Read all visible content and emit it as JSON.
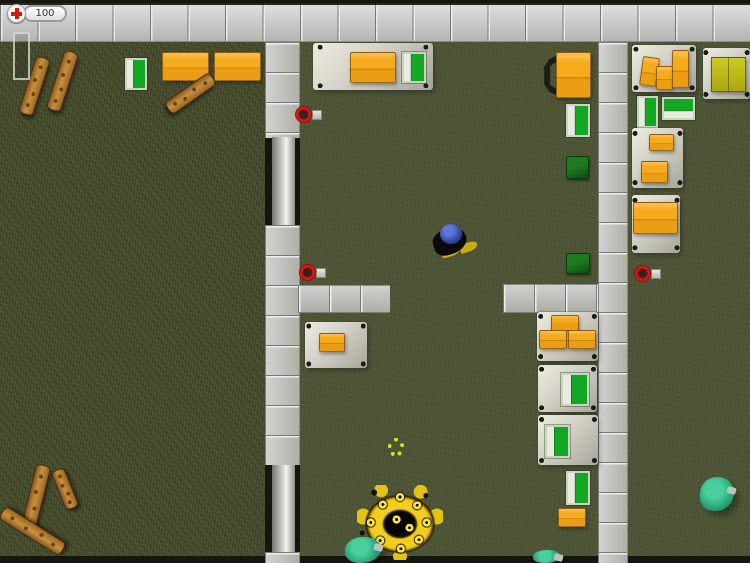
{
  "hud": {
    "health": "100",
    "health_icon": "red-cross-icon",
    "ammo_bar_fill": 0
  },
  "colors": {
    "grass": "#4a5030",
    "room_floor": "#4e5536",
    "wall_tile": "#c4c4c4",
    "crate_orange": "#f6ab1d",
    "crate_yellow": "#cdca22",
    "bed_green": "#12a824",
    "crate_dark_green": "#1d7c1f",
    "zombie_teal": "#26a076",
    "explosion_yellow": "#f1ce1d",
    "pickup_red": "#d11c1c",
    "wood": "#b0772f"
  },
  "scene": {
    "objects": [
      {
        "type": "floor-field",
        "name": "grass-field",
        "x": 0,
        "y": 42,
        "w": 265,
        "h": 521,
        "interactable": false
      },
      {
        "type": "floor-room",
        "name": "room-floor-middle",
        "x": 300,
        "y": 42,
        "w": 298,
        "h": 521,
        "interactable": false
      },
      {
        "type": "floor-room",
        "name": "room-floor-right",
        "x": 628,
        "y": 42,
        "w": 122,
        "h": 521,
        "interactable": false
      },
      {
        "type": "strip-dark",
        "name": "bottom-map-edge",
        "x": 0,
        "y": 556,
        "w": 750,
        "h": 7,
        "interactable": false
      },
      {
        "type": "wall-top",
        "name": "wall-top",
        "x": 0,
        "y": 3,
        "w": 750,
        "h": 39,
        "interactable": false
      },
      {
        "type": "wall-v",
        "name": "wall-left-upper",
        "x": 265,
        "y": 42,
        "w": 35,
        "h": 96,
        "interactable": false
      },
      {
        "type": "door-v",
        "name": "glass-door-upper",
        "x": 272,
        "y": 137,
        "w": 23,
        "h": 88,
        "interactable": true
      },
      {
        "type": "wall-v",
        "name": "wall-left-middle",
        "x": 265,
        "y": 225,
        "w": 35,
        "h": 240,
        "interactable": false
      },
      {
        "type": "door-v",
        "name": "glass-door-lower",
        "x": 272,
        "y": 465,
        "w": 23,
        "h": 87,
        "interactable": true
      },
      {
        "type": "wall-v",
        "name": "wall-left-bottom",
        "x": 265,
        "y": 552,
        "w": 35,
        "h": 11,
        "interactable": false
      },
      {
        "type": "wall-h",
        "name": "wall-branch-west",
        "x": 298,
        "y": 285,
        "w": 92,
        "h": 28,
        "interactable": false
      },
      {
        "type": "wall-h",
        "name": "wall-branch-east",
        "x": 503,
        "y": 284,
        "w": 95,
        "h": 29,
        "interactable": false
      },
      {
        "type": "wall-v",
        "name": "wall-right",
        "x": 598,
        "y": 42,
        "w": 30,
        "h": 521,
        "interactable": false
      },
      {
        "type": "plank",
        "name": "wooden-plank",
        "x": 27,
        "y": 56,
        "w": 15,
        "h": 60,
        "rot": 18,
        "interactable": false
      },
      {
        "type": "plank",
        "name": "wooden-plank",
        "x": 55,
        "y": 50,
        "w": 15,
        "h": 62,
        "rot": 18,
        "interactable": false
      },
      {
        "type": "bed-v",
        "name": "green-bed",
        "x": 125,
        "y": 58,
        "w": 22,
        "h": 32,
        "interactable": false
      },
      {
        "type": "crate-orange",
        "name": "orange-crate",
        "x": 162,
        "y": 52,
        "w": 47,
        "h": 29,
        "interactable": false
      },
      {
        "type": "crate-orange",
        "name": "orange-crate",
        "x": 214,
        "y": 52,
        "w": 47,
        "h": 29,
        "interactable": false
      },
      {
        "type": "plank",
        "name": "wooden-plank",
        "x": 183,
        "y": 66,
        "w": 15,
        "h": 55,
        "rot": 55,
        "interactable": false
      },
      {
        "type": "plank",
        "name": "wooden-plank",
        "x": 28,
        "y": 464,
        "w": 15,
        "h": 70,
        "rot": 14,
        "interactable": false
      },
      {
        "type": "plank",
        "name": "wooden-plank",
        "x": 25,
        "y": 495,
        "w": 15,
        "h": 72,
        "rot": -58,
        "interactable": false
      },
      {
        "type": "plank",
        "name": "wooden-plank",
        "x": 58,
        "y": 468,
        "w": 14,
        "h": 42,
        "rot": -22,
        "interactable": false
      },
      {
        "type": "platform",
        "name": "metal-table",
        "x": 313,
        "y": 43,
        "w": 120,
        "h": 47,
        "interactable": false
      },
      {
        "type": "crate-orange",
        "name": "orange-crate",
        "x": 350,
        "y": 52,
        "w": 46,
        "h": 31,
        "interactable": false
      },
      {
        "type": "bed-v",
        "name": "green-bed",
        "x": 402,
        "y": 52,
        "w": 24,
        "h": 31,
        "interactable": false
      },
      {
        "type": "item-red",
        "name": "weapon-pickup",
        "x": 295,
        "y": 106,
        "w": 27,
        "h": 17,
        "interactable": true
      },
      {
        "type": "locker",
        "name": "shelf-frame",
        "x": 542,
        "y": 54,
        "w": 18,
        "h": 43,
        "interactable": false
      },
      {
        "type": "crate-orange",
        "name": "orange-crate",
        "x": 556,
        "y": 52,
        "w": 35,
        "h": 46,
        "interactable": false
      },
      {
        "type": "bed-v",
        "name": "green-bed",
        "x": 566,
        "y": 104,
        "w": 24,
        "h": 33,
        "interactable": false
      },
      {
        "type": "crate-darkgreen",
        "name": "dark-green-crate",
        "x": 566,
        "y": 156,
        "w": 23,
        "h": 23,
        "interactable": false
      },
      {
        "type": "crate-darkgreen",
        "name": "dark-green-crate",
        "x": 566,
        "y": 253,
        "w": 24,
        "h": 21,
        "interactable": false
      },
      {
        "type": "item-red",
        "name": "weapon-pickup",
        "x": 299,
        "y": 264,
        "w": 27,
        "h": 17,
        "interactable": true
      },
      {
        "type": "player",
        "name": "player-character",
        "x": 430,
        "y": 220,
        "w": 42,
        "h": 42,
        "interactable": true
      },
      {
        "type": "platform",
        "name": "metal-table",
        "x": 305,
        "y": 322,
        "w": 62,
        "h": 46,
        "interactable": false
      },
      {
        "type": "crate-orange-s",
        "name": "orange-crate",
        "x": 319,
        "y": 333,
        "w": 26,
        "h": 19,
        "interactable": false
      },
      {
        "type": "platform",
        "name": "metal-table",
        "x": 537,
        "y": 312,
        "w": 61,
        "h": 49,
        "interactable": false
      },
      {
        "type": "crate-orange-s",
        "name": "orange-crate",
        "x": 551,
        "y": 315,
        "w": 28,
        "h": 16,
        "interactable": false
      },
      {
        "type": "crate-orange-s",
        "name": "orange-crate",
        "x": 539,
        "y": 330,
        "w": 28,
        "h": 19,
        "interactable": false
      },
      {
        "type": "crate-orange-s",
        "name": "orange-crate",
        "x": 568,
        "y": 330,
        "w": 28,
        "h": 19,
        "interactable": false
      },
      {
        "type": "platform",
        "name": "bed-frame",
        "x": 538,
        "y": 365,
        "w": 59,
        "h": 47,
        "interactable": false
      },
      {
        "type": "bed-v",
        "name": "green-bed",
        "x": 561,
        "y": 373,
        "w": 28,
        "h": 33,
        "interactable": false
      },
      {
        "type": "platform",
        "name": "bed-frame",
        "x": 538,
        "y": 415,
        "w": 60,
        "h": 50,
        "interactable": false
      },
      {
        "type": "bed-v",
        "name": "green-bed",
        "x": 545,
        "y": 425,
        "w": 25,
        "h": 33,
        "interactable": false
      },
      {
        "type": "bed-v",
        "name": "green-bed",
        "x": 566,
        "y": 471,
        "w": 24,
        "h": 34,
        "interactable": false
      },
      {
        "type": "crate-orange-s",
        "name": "orange-crate",
        "x": 558,
        "y": 508,
        "w": 28,
        "h": 19,
        "interactable": false
      },
      {
        "type": "marker",
        "name": "yellow-marker",
        "x": 388,
        "y": 438,
        "w": 16,
        "h": 18,
        "interactable": false
      },
      {
        "type": "explosion",
        "name": "explosion",
        "x": 357,
        "y": 485,
        "w": 86,
        "h": 75,
        "interactable": false
      },
      {
        "type": "zombie",
        "name": "zombie",
        "x": 345,
        "y": 537,
        "w": 36,
        "h": 26,
        "interactable": true
      },
      {
        "type": "zombie",
        "name": "zombie",
        "x": 533,
        "y": 550,
        "w": 28,
        "h": 13,
        "interactable": true
      },
      {
        "type": "platform",
        "name": "metal-table",
        "x": 632,
        "y": 45,
        "w": 64,
        "h": 47,
        "interactable": false
      },
      {
        "type": "crate-orange-s",
        "name": "orange-crate",
        "x": 641,
        "y": 57,
        "w": 17,
        "h": 29,
        "rot": 8,
        "interactable": false
      },
      {
        "type": "crate-orange-s",
        "name": "orange-crate",
        "x": 656,
        "y": 66,
        "w": 17,
        "h": 24,
        "interactable": false
      },
      {
        "type": "crate-orange-s",
        "name": "orange-crate",
        "x": 672,
        "y": 50,
        "w": 17,
        "h": 38,
        "interactable": false
      },
      {
        "type": "platform",
        "name": "metal-table",
        "x": 703,
        "y": 48,
        "w": 47,
        "h": 51,
        "interactable": false
      },
      {
        "type": "crate-yellow",
        "name": "yellow-crate",
        "x": 711,
        "y": 57,
        "w": 35,
        "h": 35,
        "interactable": false
      },
      {
        "type": "bed-v",
        "name": "green-bed",
        "x": 637,
        "y": 96,
        "w": 21,
        "h": 32,
        "interactable": false
      },
      {
        "type": "bed-h",
        "name": "green-bed",
        "x": 662,
        "y": 97,
        "w": 33,
        "h": 23,
        "interactable": false
      },
      {
        "type": "platform",
        "name": "metal-table",
        "x": 632,
        "y": 128,
        "w": 51,
        "h": 60,
        "interactable": false
      },
      {
        "type": "crate-orange-s",
        "name": "orange-crate",
        "x": 649,
        "y": 134,
        "w": 25,
        "h": 17,
        "interactable": false
      },
      {
        "type": "crate-orange-s",
        "name": "orange-crate",
        "x": 641,
        "y": 161,
        "w": 27,
        "h": 22,
        "interactable": false
      },
      {
        "type": "platform",
        "name": "metal-table",
        "x": 632,
        "y": 195,
        "w": 48,
        "h": 58,
        "interactable": false
      },
      {
        "type": "crate-orange",
        "name": "orange-crate",
        "x": 633,
        "y": 202,
        "w": 45,
        "h": 32,
        "interactable": false
      },
      {
        "type": "item-red",
        "name": "weapon-pickup",
        "x": 634,
        "y": 265,
        "w": 27,
        "h": 17,
        "interactable": true
      },
      {
        "type": "zombie",
        "name": "zombie",
        "x": 700,
        "y": 477,
        "w": 34,
        "h": 34,
        "interactable": true
      }
    ]
  }
}
